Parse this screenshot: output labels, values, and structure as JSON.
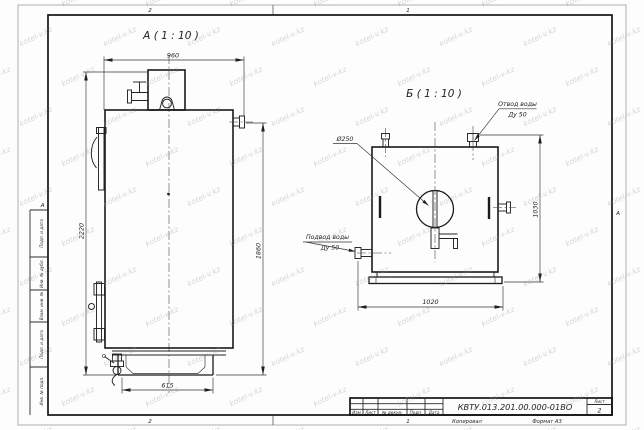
{
  "watermark": {
    "text": "kotel-v.kz"
  },
  "frame": {
    "zones_top": [
      "2",
      "1"
    ],
    "zones_bottom": [
      "2",
      "1"
    ],
    "zone_left": "А",
    "zone_right": "А",
    "side_column_cells": [
      "Подп. и дата",
      "Инв. № дубл.",
      "Взам. инв. №",
      "Подп. и дата",
      "Инв. № подл."
    ]
  },
  "title_block": {
    "designation": "КВТУ.013.201.00.000-01ВО",
    "columns": [
      "Изм",
      "Лист",
      "№ докум.",
      "Подп.",
      "Дата"
    ],
    "sheet_label": "Лист",
    "sheet_number": "2",
    "copied_label": "Копировал",
    "format_label": "Формат А3"
  },
  "view_a": {
    "label": "А ( 1 : 10 )",
    "dim_width_top": "960",
    "dim_height_overall": "2220",
    "dim_height_body": "1860",
    "dim_base_width": "615"
  },
  "view_b": {
    "label": "Б ( 1 : 10 )",
    "dim_width": "1020",
    "dim_height": "1030",
    "dim_chimney_dia": "Ø250",
    "outlet_callout_line1": "Отвод воды",
    "outlet_callout_line2": "Ду 50",
    "inlet_callout_line1": "Подвод воды",
    "inlet_callout_line2": "Ду 50"
  }
}
